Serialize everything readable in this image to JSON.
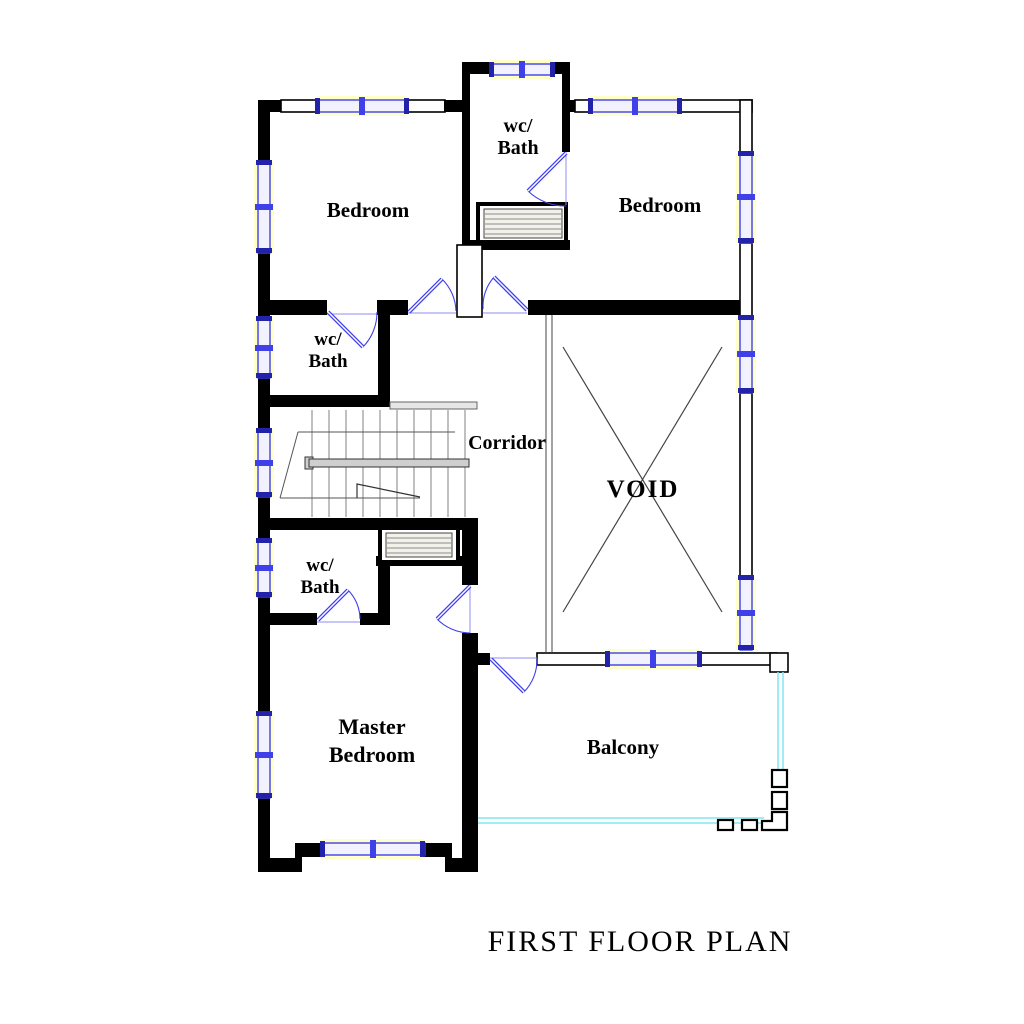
{
  "title": "FIRST FLOOR PLAN",
  "rooms": {
    "wc_bath_top": {
      "line1": "wc/",
      "line2": "Bath"
    },
    "bedroom_left": {
      "label": "Bedroom"
    },
    "bedroom_right": {
      "label": "Bedroom"
    },
    "wc_bath_middle": {
      "line1": "wc/",
      "line2": "Bath"
    },
    "corridor": {
      "label": "Corridor"
    },
    "void": {
      "label": "VOID"
    },
    "wc_bath_lower": {
      "line1": "wc/",
      "line2": "Bath"
    },
    "master_bedroom": {
      "line1": "Master",
      "line2": "Bedroom"
    },
    "balcony": {
      "label": "Balcony"
    }
  },
  "colors": {
    "wall": "#000000",
    "window_frame": "#4040e8",
    "window_cap": "#2222aa",
    "window_glow": "#ffffc8",
    "door": "#4040e8",
    "balcony_open_edge": "#80e9ef",
    "stair_lines": "#828282",
    "text": "#000000",
    "background": "#ffffff"
  }
}
